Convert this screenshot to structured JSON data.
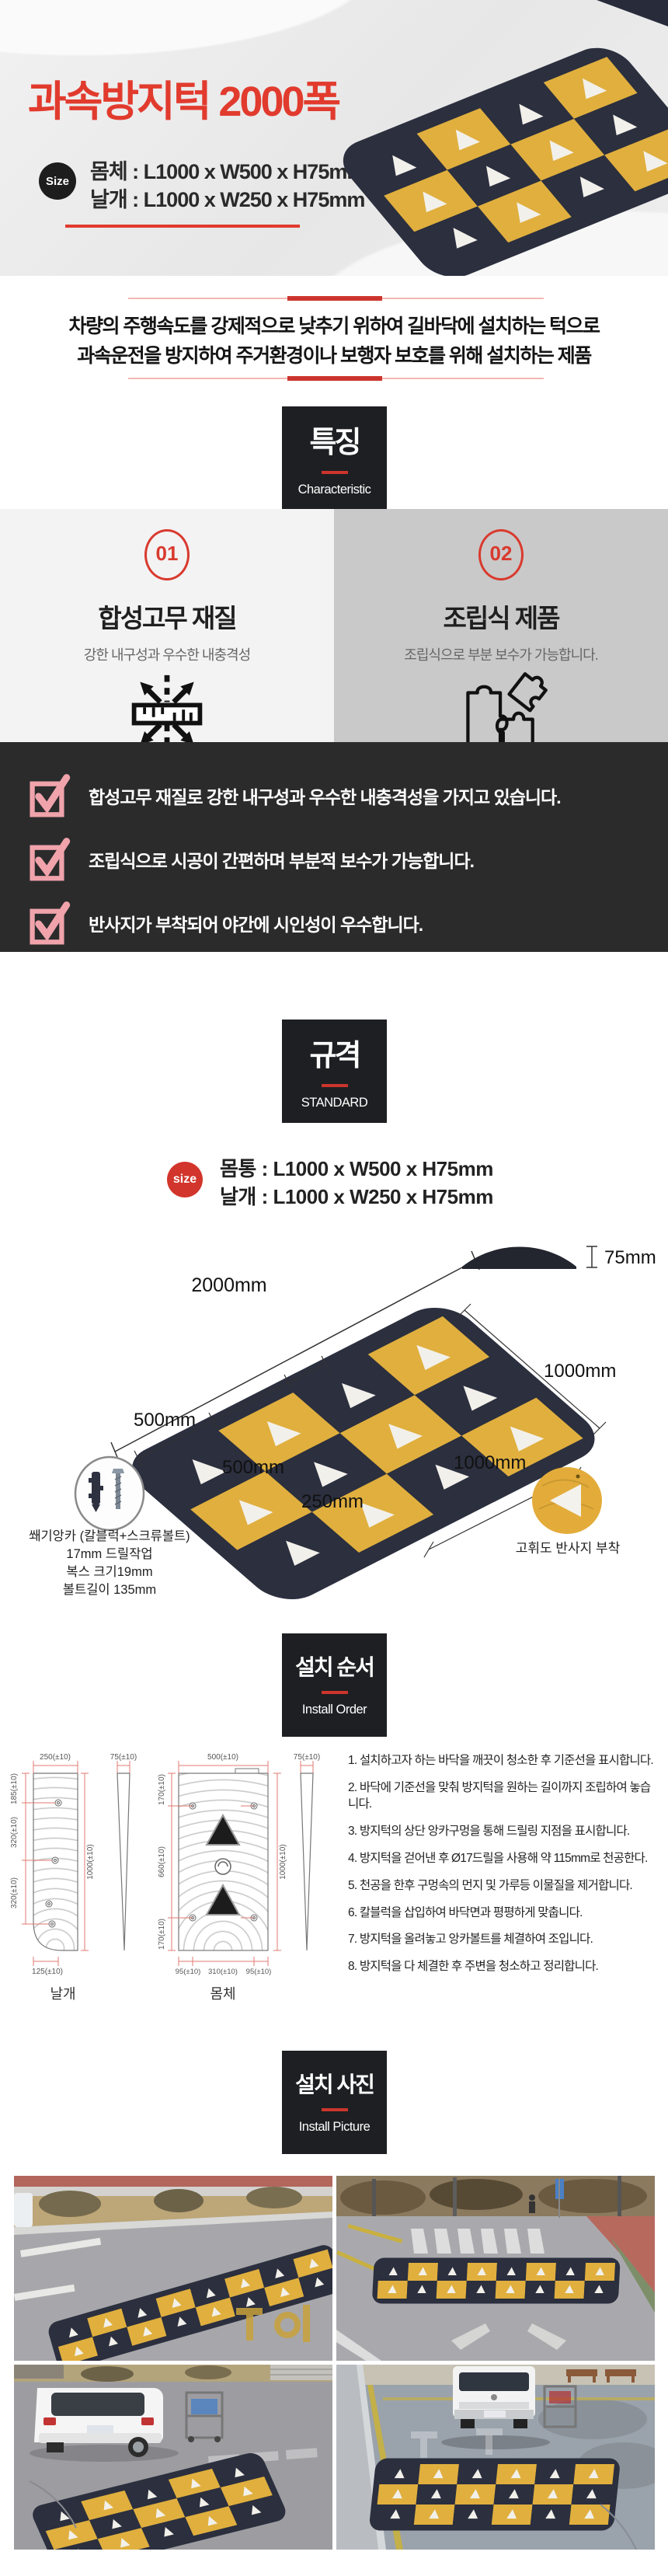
{
  "colors": {
    "accent_red": "#cc352d",
    "bump_yellow": "#e0af3e",
    "bump_navy": "#2b2f3e"
  },
  "header": {
    "title": "과속방지턱 2000폭",
    "size_badge": "Size",
    "size_line1": "몸체 : L1000 x W500 x H75mm",
    "size_line2": "날개 : L1000 x W250 x H75mm"
  },
  "intro": {
    "line1": "차량의 주행속도를 강제적으로 낮추기 위하여 길바닥에 설치하는 턱으로",
    "line2": "과속운전을 방지하여 주거환경이나 보행자 보호를 위해 설치하는 제품"
  },
  "section_characteristic": {
    "kr": "특징",
    "en": "Characteristic"
  },
  "section_standard": {
    "kr": "규격",
    "en": "STANDARD"
  },
  "section_install_order": {
    "kr": "설치 순서",
    "en": "Install Order"
  },
  "section_install_picture": {
    "kr": "설치 사진",
    "en": "Install Picture"
  },
  "features": [
    {
      "num": "01",
      "title": "합성고무 재질",
      "desc": "강한 내구성과 우수한 내충격성"
    },
    {
      "num": "02",
      "title": "조립식 제품",
      "desc": "조립식으로 부분 보수가 가능합니다."
    }
  ],
  "checklist": [
    "합성고무 재질로 강한 내구성과 우수한 내충격성을 가지고 있습니다.",
    "조립식으로 시공이 간편하며 부분적 보수가 가능합니다.",
    "반사지가 부착되어 야간에 시인성이 우수합니다."
  ],
  "standard": {
    "size_badge": "size",
    "size_line1": "몸통 : L1000 x W500 x H75mm",
    "size_line2": "날개 : L1000 x W250 x H75mm"
  },
  "diagram": {
    "total_width": "2000mm",
    "height": "75mm",
    "right_len1": "1000mm",
    "right_len2": "1000mm",
    "body_w1": "500mm",
    "body_w2": "500mm",
    "wing_w": "250mm",
    "anchor_caption1": "쐐기앙카 (칼블럭+스크류볼트)",
    "anchor_caption2": "17mm 드릴작업",
    "anchor_caption3": "복스 크기19mm",
    "anchor_caption4": "볼트길이 135mm",
    "reflector_caption": "고휘도 반사지 부착"
  },
  "drawings": {
    "wing": {
      "label": "날개",
      "top": "250(±10)",
      "thickness": "75(±10)",
      "left1": "185(±10)",
      "left2": "320(±10)",
      "left3": "320(±10)",
      "right": "1000(±10)",
      "bottom": "125(±10)"
    },
    "body": {
      "label": "몸체",
      "top": "500(±10)",
      "thickness": "75(±10)",
      "left1": "170(±10)",
      "left2": "660(±10)",
      "left3": "170(±10)",
      "right": "1000(±10)",
      "bottom1": "95(±10)",
      "bottom2": "310(±10)",
      "bottom3": "95(±10)"
    }
  },
  "install_steps": [
    "1. 설치하고자 하는 바닥을 깨끗이 청소한 후 기준선을 표시합니다.",
    "2. 바닥에 기준선을 맞춰 방지턱을 원하는 길이까지 조립하여 놓습니다.",
    "3. 방지턱의 상단 앙카구멍을 통해 드릴링 지점을 표시합니다.",
    "4. 방지턱을 걷어낸 후 Ø17드릴을 사용해 약 115mm로 천공한다.",
    "5. 천공을 한후 구멍속의 먼지 및 가루등 이물질을 제거합니다.",
    "6. 칼블럭을 삽입하여 바닥면과 평평하게 맞춥니다.",
    "7. 방지턱을 올려놓고 앙카볼트를 체결하여 조입니다.",
    "8. 방지턱을 다 체결한 후 주변을 청소하고 정리합니다."
  ]
}
